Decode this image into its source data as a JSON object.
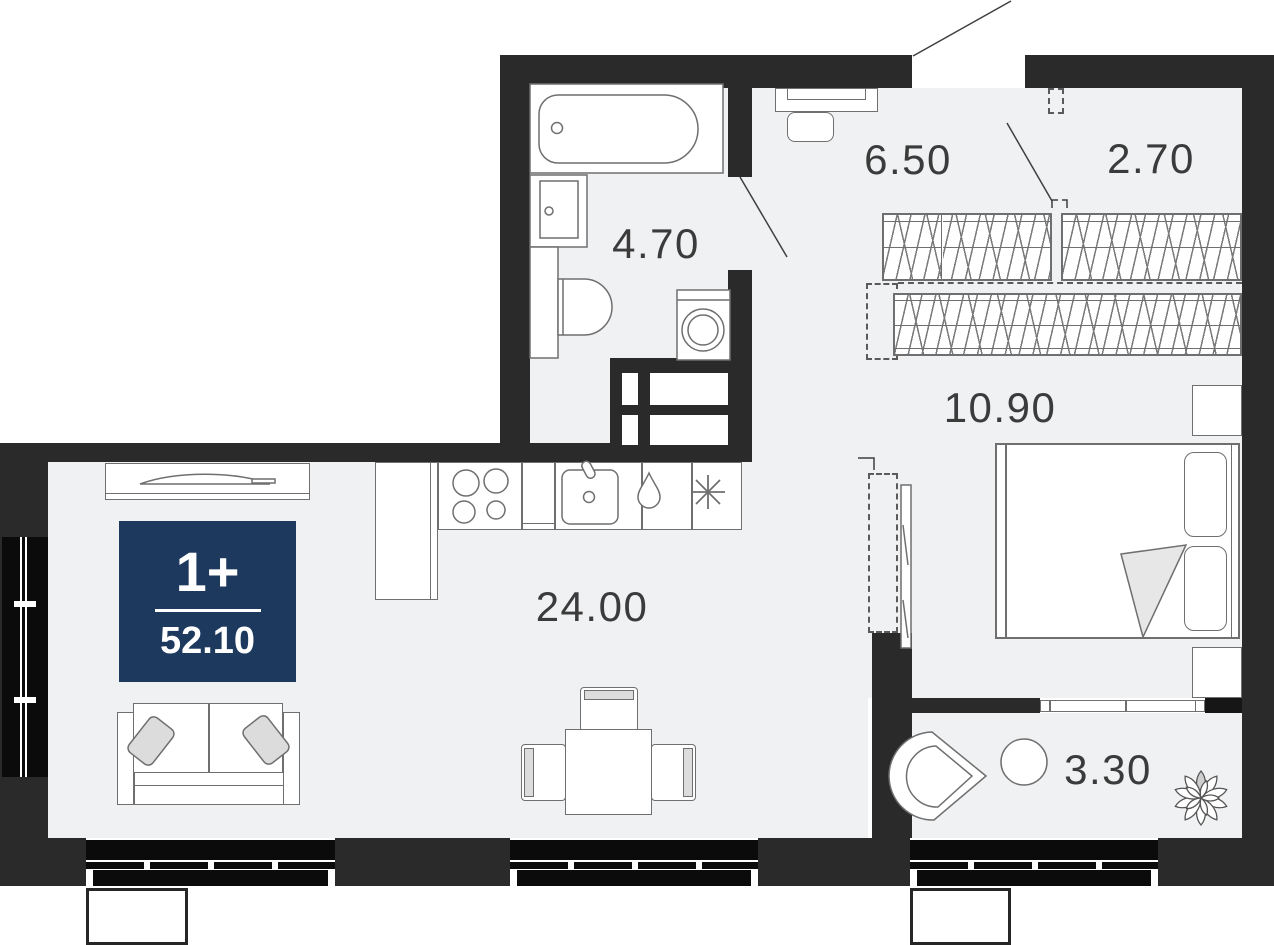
{
  "plan": {
    "title": "apartment-floor-plan",
    "badge": {
      "rooms": "1+",
      "area": "52.10"
    },
    "rooms": {
      "hall": "6.50",
      "wardrobe": "2.70",
      "bathroom": "4.70",
      "corridor": "10.90",
      "living_kitchen": "24.00",
      "loggia": "3.30"
    },
    "colors": {
      "wall": "#2a2a2a",
      "floor": "#f0f1f2",
      "line": "#6f6f6f",
      "glass": "#0b0b0b",
      "badge_bg": "#1d3a5e",
      "badge_text": "#ffffff",
      "label_text": "#3b3b3b"
    }
  }
}
